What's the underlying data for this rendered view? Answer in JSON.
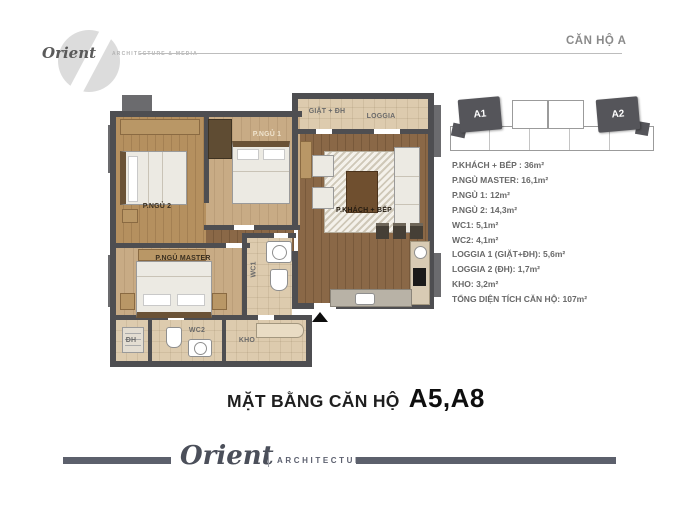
{
  "header": {
    "brand": "Orient",
    "brand_tagline": "ARCHITECTURE & MEDIA",
    "unit_title": "CĂN HỘ A"
  },
  "keyplan": {
    "unit_a1": "A1",
    "unit_a2": "A2"
  },
  "specs": {
    "items": [
      {
        "text": "P.KHÁCH + BẾP : 36m²"
      },
      {
        "text": "P.NGỦ MASTER: 16,1m²"
      },
      {
        "text": "P.NGỦ 1: 12m²"
      },
      {
        "text": "P.NGỦ 2: 14,3m²"
      },
      {
        "text": "WC1: 5,1m²"
      },
      {
        "text": "WC2: 4,1m²"
      },
      {
        "text": "LOGGIA 1 (GIẶT+ĐH): 5,6m²"
      },
      {
        "text": "LOGGIA 2 (ĐH): 1,7m²"
      },
      {
        "text": "KHO: 3,2m²"
      },
      {
        "text": "TỔNG DIỆN TÍCH CĂN HỘ: 107m²"
      }
    ]
  },
  "plan": {
    "labels": {
      "giat_dh": "GIẶT + ĐH",
      "loggia": "LOGGIA",
      "p_ngu_1": "P.NGỦ 1",
      "p_ngu_2": "P.NGỦ 2",
      "p_ngu_master": "P.NGỦ MASTER",
      "p_khach_bep": "P.KHÁCH + BẾP",
      "wc1": "WC1",
      "wc2": "WC2",
      "kho": "KHO",
      "dh": "ĐH"
    }
  },
  "caption": {
    "prefix": "MẶT BẰNG CĂN HỘ",
    "units": "A5,A8"
  },
  "footer": {
    "brand": "Orient",
    "tagline": "ARCHITECTURE & MEDIA"
  },
  "colors": {
    "wall": "#4e4e51",
    "wood_dark": "#8a6847",
    "wood_light": "#c8ab85",
    "tile": "#ddcbae",
    "keyplan_unit": "#55555a",
    "footer_bar": "#5c606c",
    "spec_text": "#686868",
    "title_text": "#8a8a8a"
  }
}
